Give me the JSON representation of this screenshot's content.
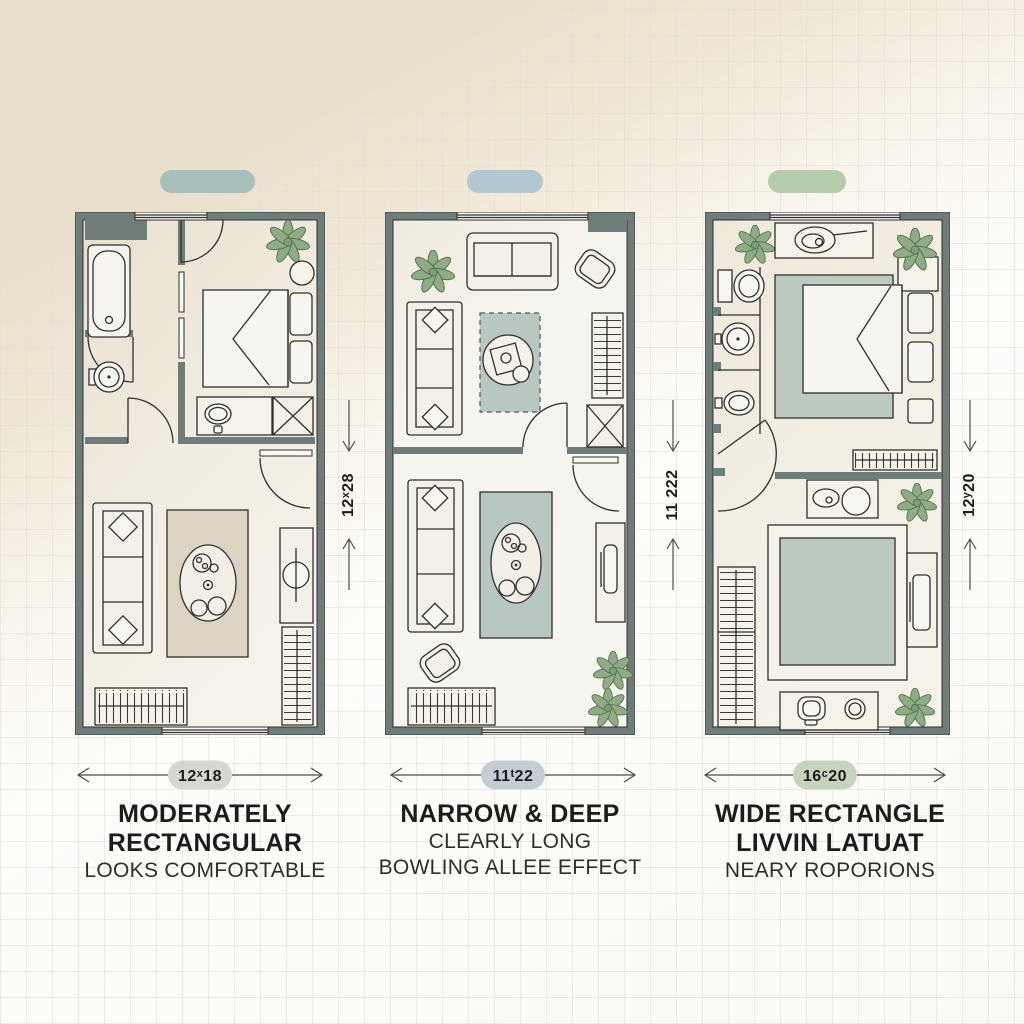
{
  "panels": [
    {
      "name": "moderately-rectangular",
      "swatch_color": "#a9bfbc",
      "plan_width_label": "12ˣ18",
      "plan_height_label": "12ˣ28",
      "pill_color": "#d7d7d1",
      "title_lines": [
        "MODERATELY",
        "RECTANGULAR"
      ],
      "subtitle_lines": [
        "LOOKS COMFORTABLE"
      ]
    },
    {
      "name": "narrow-and-deep",
      "swatch_color": "#b2c7d2",
      "plan_width_label": "11ᵗ22",
      "plan_height_label": "11 222",
      "pill_color": "#c3ced4",
      "title_lines": [
        "NARROW & DEEP"
      ],
      "subtitle_lines": [
        "CLEARLY LONG",
        "BOWLING ALLEE EFFECT"
      ]
    },
    {
      "name": "wide-rectangle",
      "swatch_color": "#b7cbad",
      "plan_width_label": "16ᶜ20",
      "plan_height_label": "12ʸ20",
      "pill_color": "#c7d3bd",
      "title_lines": [
        "WIDE RECTANGLE",
        "LIVVIN LATUAT"
      ],
      "subtitle_lines": [
        "NEARY ROPORIONS"
      ]
    }
  ],
  "colors": {
    "wall": "#6e7d7a",
    "rug_beige": "#dcd3c2",
    "rug_sage": "#b8c7c1",
    "plant_green": "#8fac84"
  }
}
